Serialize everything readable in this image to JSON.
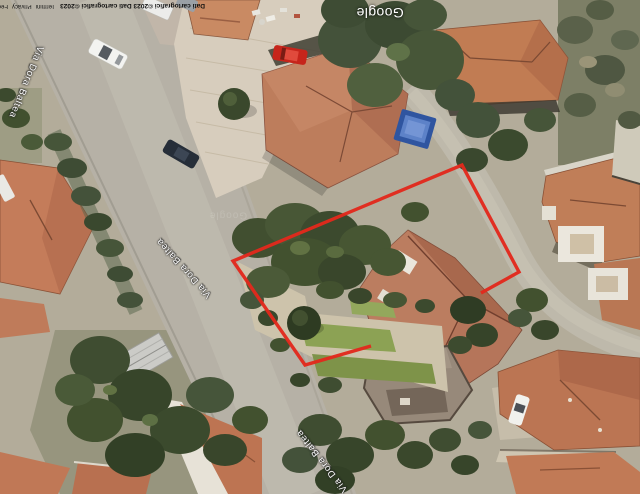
{
  "map": {
    "watermark": "Google",
    "faint_watermark": "Google",
    "attribution": {
      "copyright": "Dati cartografici ©2023 Dati cartografici ©2023",
      "links": [
        {
          "label": "Termini"
        },
        {
          "label": "Privacy"
        },
        {
          "label": "Feedback"
        }
      ]
    },
    "street_labels": [
      {
        "name": "Via Dora Baltea"
      },
      {
        "name": "Via Dora Baltea"
      },
      {
        "name": "Via Dora Baltea"
      }
    ],
    "annotation": {
      "label": "parcel boundary",
      "color": "#e2291c"
    },
    "colors": {
      "boundary": "#e2291c",
      "road": "#b6b1a6",
      "roof_terracotta": "#bd7d5c",
      "vegetation": "#44523a",
      "paving": "#d7cdbd",
      "pool_blue": "#2f55a0"
    }
  }
}
